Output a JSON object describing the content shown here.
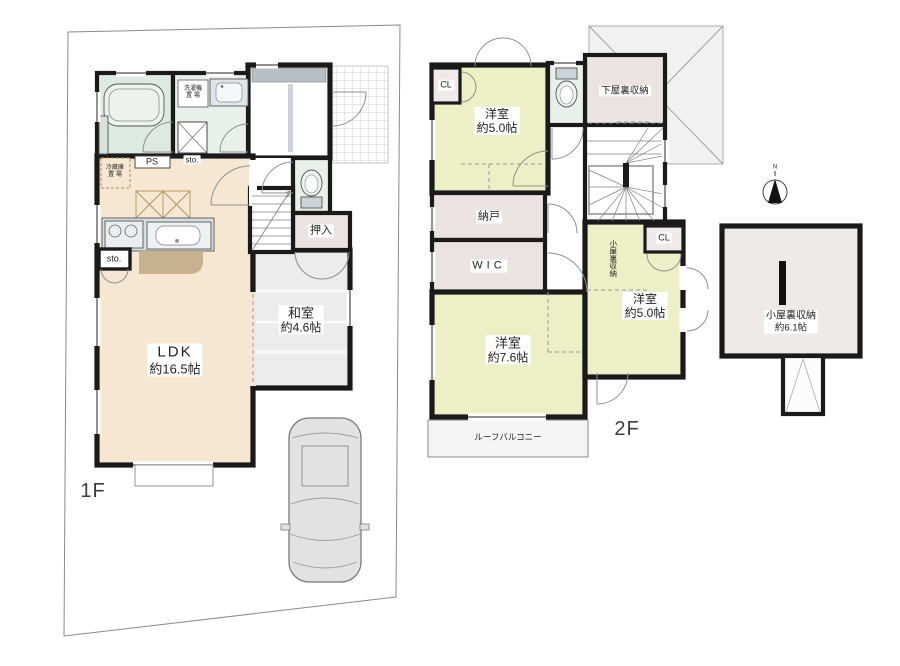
{
  "floor1": {
    "label": "1F",
    "ldk": {
      "name": "LDK",
      "size": "約16.5帖"
    },
    "washitsu": {
      "name": "和室",
      "size": "約4.6帖"
    },
    "oshiire": "押入",
    "ps": "PS",
    "sto_upper": "sto.",
    "sto_lower": "sto.",
    "washer_area": {
      "line1": "洗濯機",
      "line2": "置 場"
    },
    "fridge_area": {
      "line1": "冷蔵庫",
      "line2": "置 場"
    }
  },
  "floor2": {
    "label": "2F",
    "yoshitsu_nw": {
      "name": "洋室",
      "size": "約5.0帖"
    },
    "yoshitsu_sw": {
      "name": "洋室",
      "size": "約7.6帖"
    },
    "yoshitsu_e": {
      "name": "洋室",
      "size": "約5.0帖"
    },
    "cl_west": "CL",
    "cl_east": "CL",
    "geyaura_storage": "下屋裏収納",
    "nando": "納戸",
    "wic": "WIC",
    "koyaura_storage": "小屋裏収納",
    "roof_balcony": "ルーフバルコニー"
  },
  "attic": {
    "koyaura": {
      "name": "小屋裏収納",
      "size": "約6.1帖"
    },
    "compass_north": "N"
  },
  "colors": {
    "wall": "#1a1a1a",
    "ldk_beige": "#f5e7d1",
    "counter_brown": "#c8b18f",
    "room_yellow": "#edf0c6",
    "storage_pink": "#ebe3e1",
    "closet_pink": "#efe9e7",
    "bath_green": "#dfe9e4",
    "wash_green": "#e9efe9",
    "tatami_gray": "#ececec",
    "attic_gray": "#eeeae8"
  }
}
